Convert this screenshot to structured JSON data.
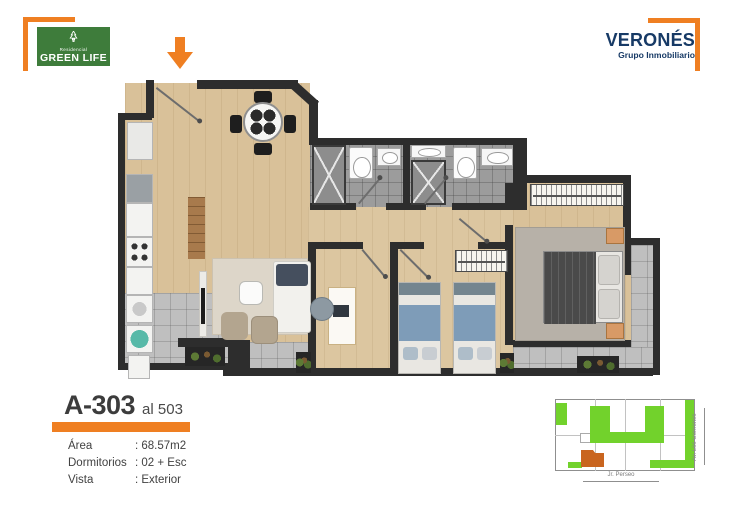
{
  "branding": {
    "residential_tag": "Residencial",
    "residence_name": "GREEN LIFE",
    "developer_name": "VERONÉS",
    "developer_tagline": "Grupo Inmobiliario"
  },
  "unit_info": {
    "unit_code": "A-303",
    "unit_range": "al 503",
    "specs": [
      {
        "label": "Área",
        "value": ": 68.57m2"
      },
      {
        "label": "Dormitorios",
        "value": ": 02 + Esc"
      },
      {
        "label": "Vista",
        "value": ": Exterior"
      }
    ]
  },
  "site_plan": {
    "street_bottom_label": "Jr. Perseo",
    "street_right_label": "Av. Los Gorriones",
    "unit_highlight_color": "#C9651F",
    "green_area_color": "#72D22C"
  },
  "icons": {
    "entrance_marker": "down-arrow-icon",
    "logo_symbol": "tree-icon"
  },
  "colors": {
    "accent_orange": "#EF7F22",
    "brand_green": "#3E7C3B",
    "developer_navy": "#173A66",
    "wall_color": "#2D2D2D",
    "wood_floor": "#D9C199",
    "tile_gray": "#BFBFBF",
    "bath_tile_gray": "#9C9C9C"
  }
}
